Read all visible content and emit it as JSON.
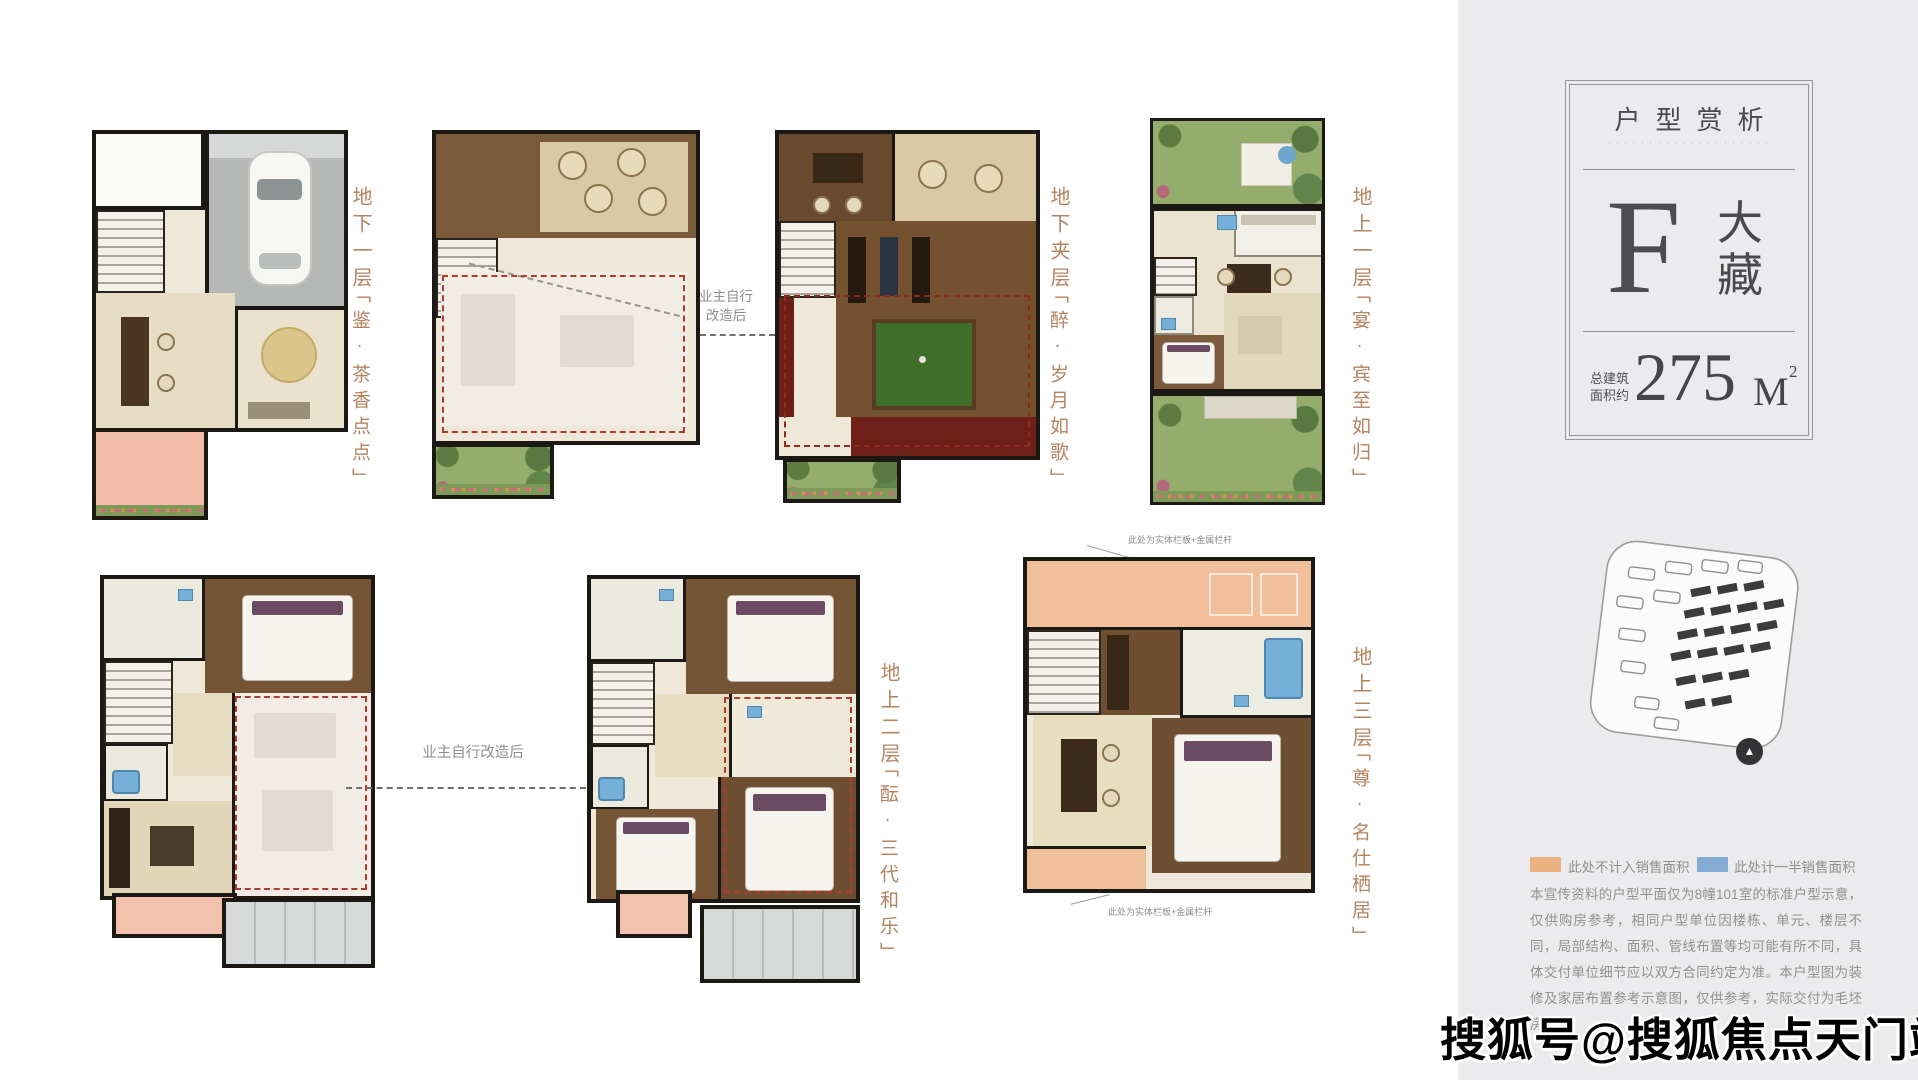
{
  "watermark": "搜狐号@搜狐焦点天门站",
  "panel": {
    "bg": "#ebebed",
    "type_card": {
      "title": "户型赏析",
      "subtitle_micro": "· · · · · · · · · ·   · · · · · · · · · ·",
      "letter": "F",
      "type_name_char1": "大",
      "type_name_char2": "藏",
      "area_label_line1": "总建筑",
      "area_label_line2": "面积约",
      "area_value": "275",
      "area_unit": "M",
      "area_sup": "2"
    },
    "compass_glyph": "▲",
    "legend": [
      {
        "color": "#eab183",
        "label": "此处不计入销售面积"
      },
      {
        "color": "#83abd3",
        "label": "此处计一半销售面积"
      }
    ],
    "disclaimer": "本宣传资料的户型平面仅为8幢101室的标准户型示意，仅供购房参考，相同户型单位因楼栋、单元、楼层不同，局部结构、面积、管线布置等均可能有所不同，具体交付单位细节应以双方合同约定为准。本户型图为装修及家居布置参考示意图，仅供参考，实际交付为毛坯房。"
  },
  "plans": [
    {
      "id": "basement-1",
      "floor": "地下一层",
      "name": "「鉴·茶香点点」"
    },
    {
      "id": "basement-mezz",
      "floor": "地下夹层",
      "name": "「醉·岁月如歌」"
    },
    {
      "id": "ground-1",
      "floor": "地上一层",
      "name": "「宴·宾至如归」"
    },
    {
      "id": "ground-2",
      "floor": "地上二层",
      "name": "「酝·三代和乐」"
    },
    {
      "id": "ground-3",
      "floor": "地上三层",
      "name": "「尊·名仕栖居」"
    }
  ],
  "connectors": {
    "top_line1": "业主自行",
    "top_line2": "改造后",
    "bottom": "业主自行改造后"
  },
  "annotations": {
    "railing_top": "此处为实体栏板+金属栏杆",
    "railing_bottom": "此处为实体栏板+金属栏杆"
  }
}
